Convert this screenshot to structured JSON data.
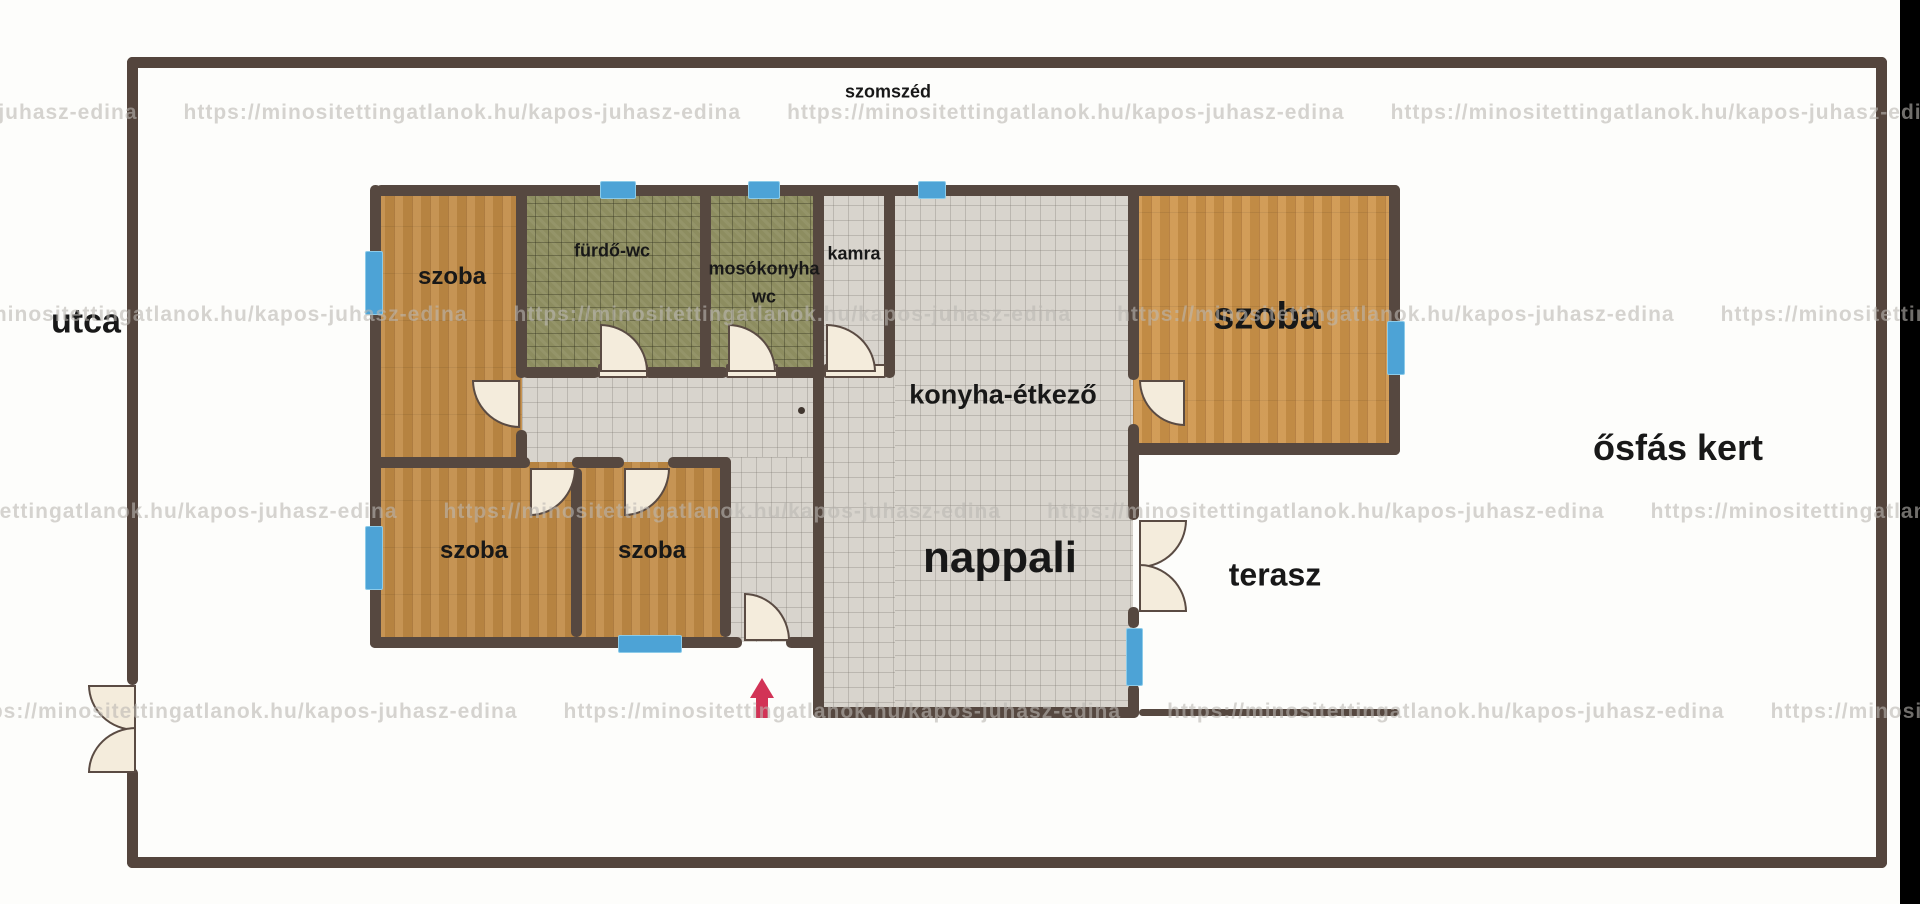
{
  "outside_labels": {
    "top_neighbor": "szomszéd",
    "street": "utca",
    "garden": "ősfás kert"
  },
  "rooms": {
    "szoba_top_left": {
      "label": "szoba"
    },
    "furdo_wc": {
      "label": "fürdő-wc"
    },
    "mosokonyha": {
      "label": "mosókonyha"
    },
    "mosokonyha_wc": {
      "label": "wc"
    },
    "kamra": {
      "label": "kamra"
    },
    "konyha_etkezo": {
      "label": "konyha-étkező"
    },
    "szoba_right": {
      "label": "szoba"
    },
    "nappali": {
      "label": "nappali"
    },
    "szoba_bottom_1": {
      "label": "szoba"
    },
    "szoba_bottom_2": {
      "label": "szoba"
    },
    "terasz": {
      "label": "terasz"
    }
  },
  "watermark": {
    "url": "https://minositettingatlanok.hu/kapos-juhasz-edina"
  },
  "icons": {
    "entrance_arrow": "up-arrow"
  },
  "palette": {
    "wall": "#564840",
    "property_border": "#54453d",
    "wood_floor": "#c18b45",
    "green_tile": "#8d8d60",
    "light_tile": "#d8d4cd",
    "window_blue": "#4da3d6",
    "door_cream": "#f4ecdc",
    "entrance_arrow_red": "#d23356",
    "label_text": "#181818",
    "watermark_gray": "#bab7b3"
  }
}
